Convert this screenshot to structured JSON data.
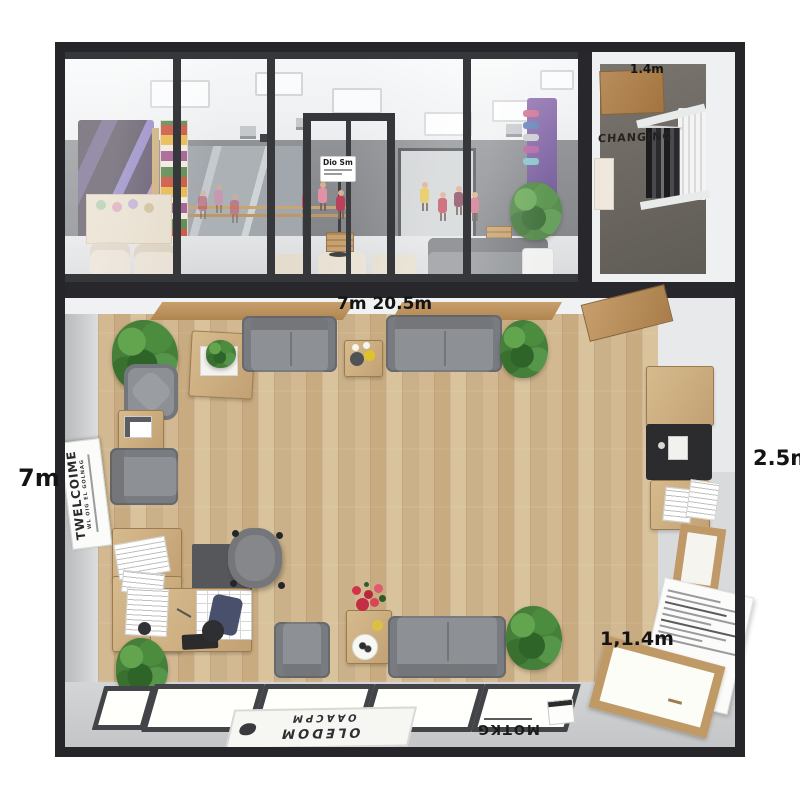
{
  "labels": {
    "top_dim": "7m 20.5m",
    "left_dim": "7m",
    "right_dim": "2.5m",
    "inner_dim": "1,1.4m",
    "changing_dim": "1.4m",
    "changing_label": "CHANGING",
    "door_sign": "Dio Sm"
  },
  "signs": {
    "welcome_main": "TWELCOIME",
    "welcome_sub": "WL OIG EL GOLNAG",
    "mat1_line1": "OLEDOM",
    "mat1_line2": "OAACPM",
    "mat2_line1": "MOTKG"
  },
  "colors": {
    "frame": "#26262a",
    "wall": "#d6d7d9",
    "wood_floor": "#cdb38c",
    "sofa": "#8d9094",
    "plant": "#467f39",
    "mural": "#8d7fc0"
  }
}
